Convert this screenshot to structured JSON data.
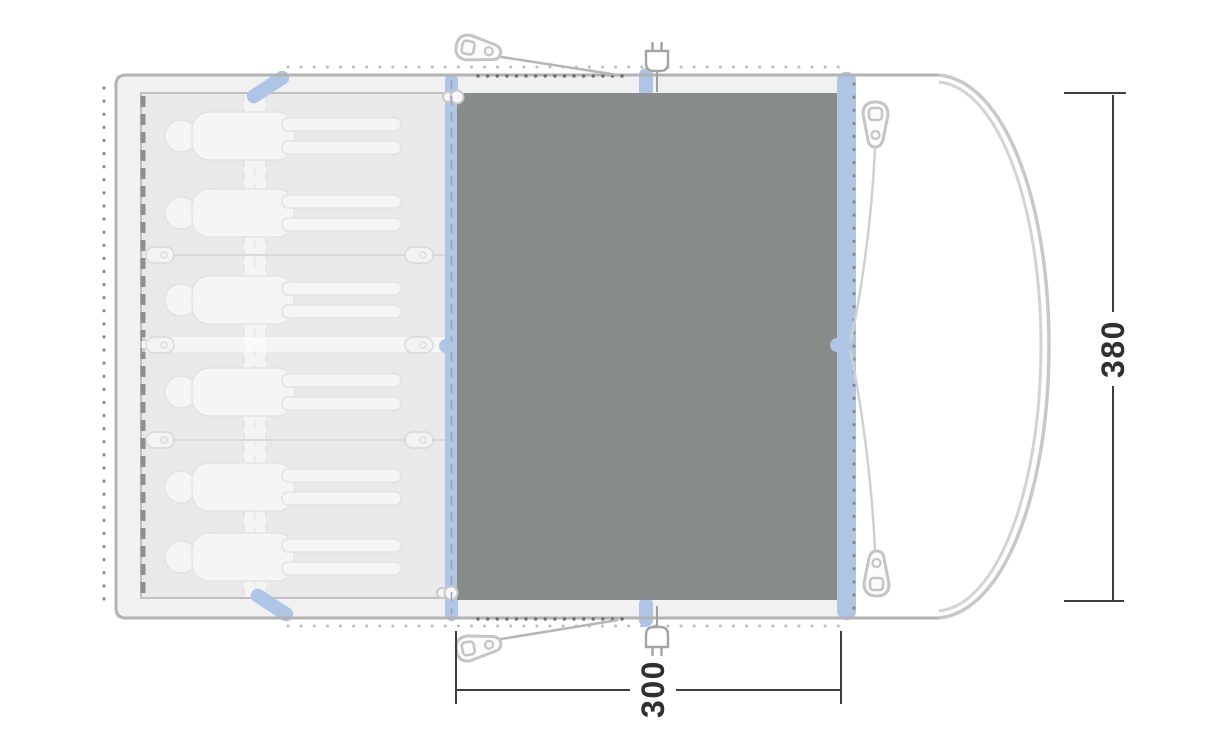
{
  "diagram": {
    "title": "tent-floorplan-top-view",
    "labels": {
      "height": "380",
      "width": "300"
    },
    "colors": {
      "groundsheet": "#878b89",
      "pole_blue": "#aec5e6",
      "tent_fill": "#f1f1f1",
      "porch_fill": "#ffffff",
      "cabin_fill": "#e9e9e9",
      "outline_gray": "#b3b3b3",
      "dimension_gray": "#3a3a3a",
      "silhouette": "#f5f5f5"
    },
    "sleeping": {
      "person_count": 6,
      "compartments": 3
    },
    "icons": [
      "tent-peg-icon",
      "power-plug-icon",
      "pole-icon",
      "toggle-icon",
      "clip-icon"
    ]
  }
}
